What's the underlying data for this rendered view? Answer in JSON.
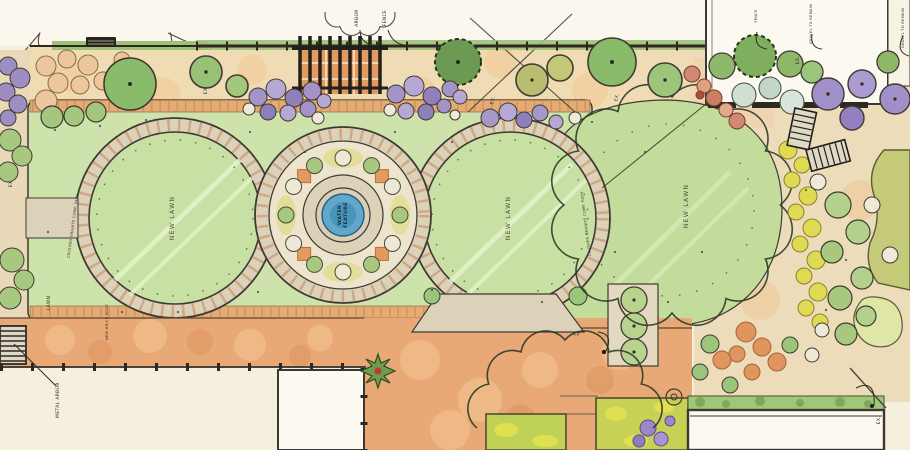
{
  "plan": {
    "type": "landscape watercolor master plan",
    "water_feature": {
      "line1": "WATER",
      "line2": "FEATURE"
    },
    "labels": {
      "new_lawn": "NEW LAWN",
      "lawn": "LAWN",
      "granite_path": "CRUSHED GRANITE COMP. PATH",
      "arbor": "ARBOR",
      "fence": "FENCE",
      "metal_arbor": "METAL ARBOR",
      "new_brick_edge": "NEW BRICK EDGE",
      "existing": "EX.",
      "fire_pit": "FP",
      "gravel_note": "GRAVEL TO REMAIN"
    },
    "colors": {
      "paper": "#f5efdd",
      "lawn_green": "#cde3ab",
      "path_tan": "#dcd2ba",
      "brick_orange": "#e9a977",
      "water_blue": "#5fa8cc",
      "tree_green": "#8fb96a",
      "shrub_purple": "#a08fc8",
      "flower_yellow": "#e0da52",
      "ink": "#3b3731"
    }
  }
}
